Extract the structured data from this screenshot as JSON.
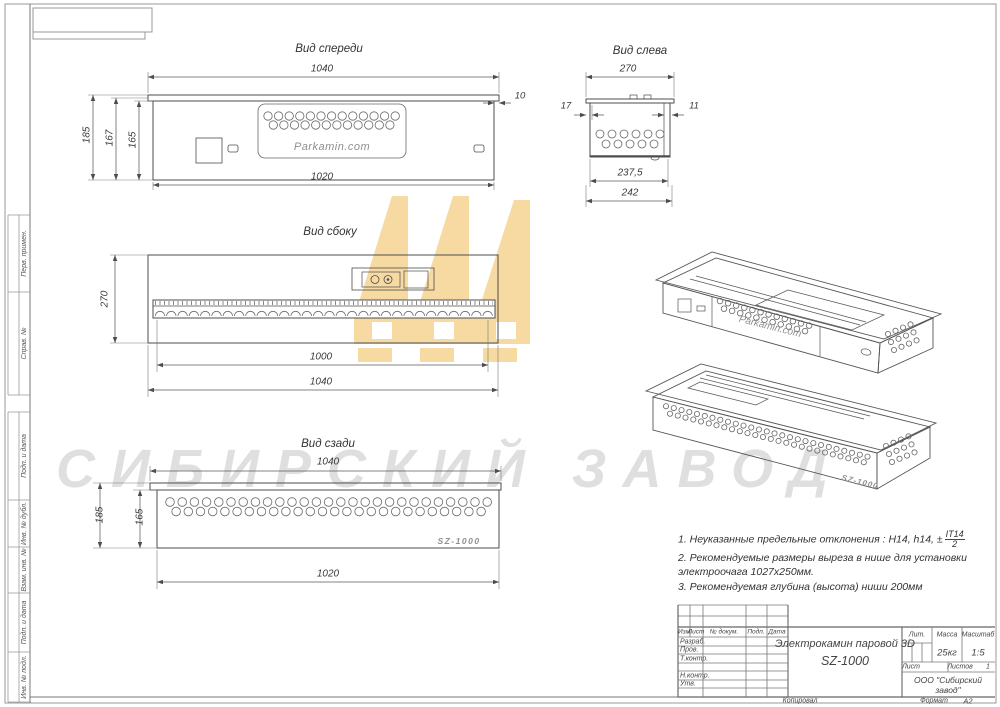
{
  "watermark": {
    "text": "СИБИРСКИЙ ЗАВОД",
    "text_color": "#DFDFDF",
    "logo_color": "#F6DAA2"
  },
  "views": {
    "front": {
      "title": "Вид спереди",
      "dim_width_flange": "1040",
      "dim_overhang": "10",
      "dim_width_body": "1020",
      "dim_height_full": "185",
      "dim_height_mid": "167",
      "dim_height_body": "165",
      "brand": "Parkamin.com"
    },
    "left": {
      "title": "Вид слева",
      "dim_width": "270",
      "dim_offset_left": "17",
      "dim_offset_right": "11",
      "dim_width_inner": "237,5",
      "dim_width_outer": "242"
    },
    "side": {
      "title": "Вид сбоку",
      "dim_depth": "270",
      "dim_slot": "1000",
      "dim_length": "1040"
    },
    "rear": {
      "title": "Вид сзади",
      "dim_width_flange": "1040",
      "dim_height_full": "185",
      "dim_height_body": "165",
      "dim_width_body": "1020",
      "model": "SZ-1000"
    },
    "iso_front": {
      "brand": "Parkamin.com"
    },
    "iso_rear": {
      "model": "SZ-1000"
    }
  },
  "notes": {
    "n1": "1. Неуказанные предельные отклонения : H14, h14, ±",
    "n1_frac_num": "IT14",
    "n1_frac_den": "2",
    "n2": "2. Рекомендуемые размеры выреза в нише для установки электроочага 1027х250мм.",
    "n3": "3. Рекомендуемая глубина (высота) ниши 200мм"
  },
  "title_block": {
    "col_izm": "Изм",
    "col_list": "Лист",
    "col_doc": "№ докум.",
    "col_sign": "Подп.",
    "col_date": "Дата",
    "row_developed": "Разраб.",
    "row_checked": "Пров.",
    "row_tcontrol": "Т.контр.",
    "row_ncontrol": "Н.контр.",
    "row_approved": "Утв.",
    "doc_title": "Электрокамин паровой 3D",
    "doc_model": "SZ-1000",
    "lit_label": "Лит.",
    "mass_label": "Масса",
    "scale_label": "Масштаб",
    "mass_value": "25кг",
    "scale_value": "1:5",
    "sheet_label": "Лист",
    "sheets_label": "Листов",
    "sheets_value": "1",
    "company_line1": "ООО \"Сибирский",
    "company_line2": "завод\"",
    "copied_by": "Копировал",
    "format_label": "Формат",
    "format_value": "А2"
  },
  "margin": {
    "perv_primen": "Перв. примен.",
    "sprav_no": "Справ. №",
    "podp_data_1": "Подп. и дата",
    "inv_dubl": "Инв. № дубл.",
    "vzam_inv": "Взам. инв. №",
    "podp_data_2": "Подп. и дата",
    "inv_podl": "Инв. № подл."
  }
}
